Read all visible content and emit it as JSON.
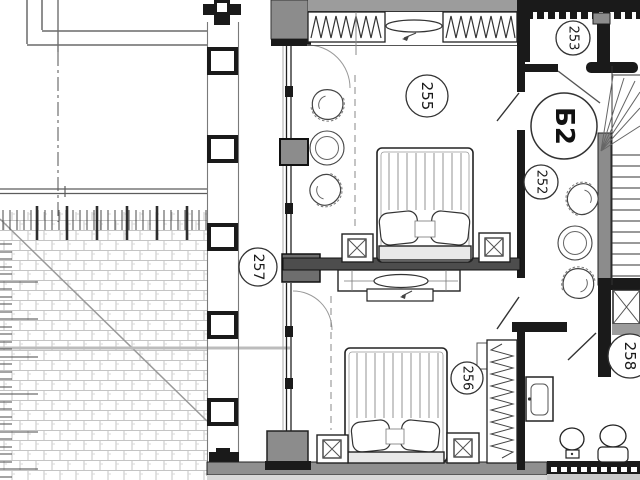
{
  "plan": {
    "unit_label": "Б2",
    "room_labels": {
      "r255": "255",
      "r253": "253",
      "r252": "252",
      "r257": "257",
      "r256": "256",
      "r258": "258"
    },
    "colors": {
      "wall_dark": "#1a1a1a",
      "wall_mid": "#4d4d4d",
      "wall_gray": "#8c8c8c",
      "band_gray": "#9c9c9c",
      "hatch_line": "#c4c4c4",
      "line": "#333333",
      "background": "#ffffff"
    },
    "symbols": [
      "double-bed",
      "pillow",
      "nightstand-lamp",
      "tub-chair",
      "round-table",
      "dresser-tv",
      "wardrobe-hangers",
      "sink-vanity",
      "toilet",
      "bidet",
      "stairs",
      "elevator-shaft",
      "door-swing",
      "window-accordion",
      "column",
      "roof-hatch",
      "railing"
    ]
  }
}
